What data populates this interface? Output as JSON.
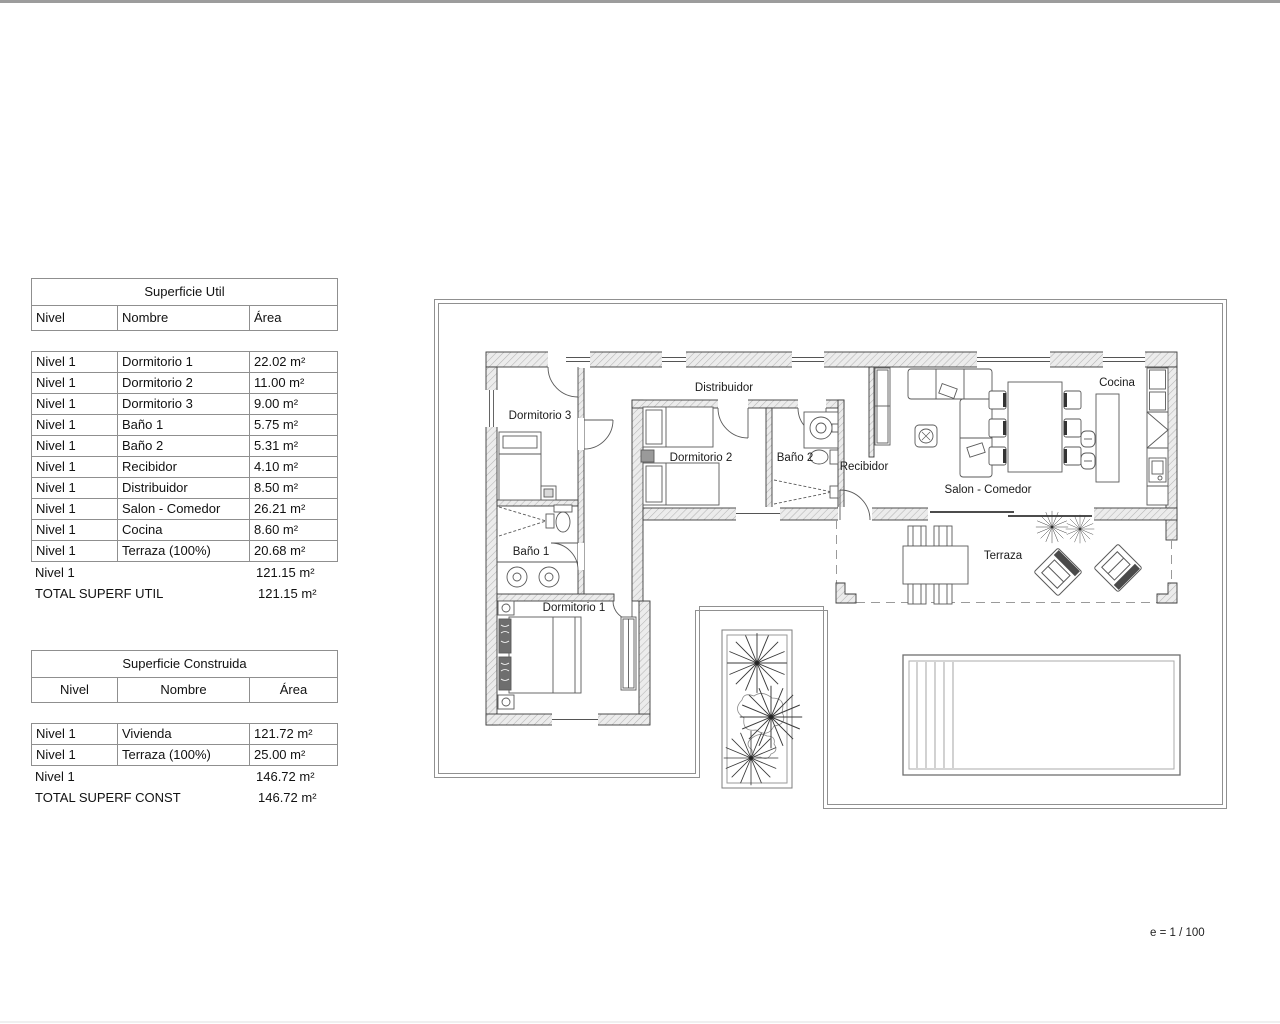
{
  "tables": {
    "util": {
      "title": "Superficie Util",
      "headers": [
        "Nivel",
        "Nombre",
        "Área"
      ],
      "rows": [
        {
          "nivel": "Nivel 1",
          "nombre": "Dormitorio 1",
          "area": "22.02 m²"
        },
        {
          "nivel": "Nivel 1",
          "nombre": "Dormitorio 2",
          "area": "11.00 m²"
        },
        {
          "nivel": "Nivel 1",
          "nombre": "Dormitorio 3",
          "area": "9.00 m²"
        },
        {
          "nivel": "Nivel 1",
          "nombre": "Baño 1",
          "area": "5.75 m²"
        },
        {
          "nivel": "Nivel 1",
          "nombre": "Baño 2",
          "area": "5.31 m²"
        },
        {
          "nivel": "Nivel 1",
          "nombre": "Recibidor",
          "area": "4.10 m²"
        },
        {
          "nivel": "Nivel 1",
          "nombre": "Distribuidor",
          "area": "8.50 m²"
        },
        {
          "nivel": "Nivel 1",
          "nombre": "Salon - Comedor",
          "area": "26.21 m²"
        },
        {
          "nivel": "Nivel 1",
          "nombre": "Cocina",
          "area": "8.60 m²"
        },
        {
          "nivel": "Nivel 1",
          "nombre": "Terraza (100%)",
          "area": "20.68 m²"
        }
      ],
      "subtotal": {
        "label": "Nivel 1",
        "area": "121.15 m²"
      },
      "total": {
        "label": "TOTAL SUPERF UTIL",
        "area": "121.15 m²"
      }
    },
    "construida": {
      "title": "Superficie Construida",
      "headers": [
        "Nivel",
        "Nombre",
        "Área"
      ],
      "rows": [
        {
          "nivel": "Nivel 1",
          "nombre": "Vivienda",
          "area": "121.72 m²"
        },
        {
          "nivel": "Nivel 1",
          "nombre": "Terraza (100%)",
          "area": "25.00 m²"
        }
      ],
      "subtotal": {
        "label": "Nivel 1",
        "area": "146.72 m²"
      },
      "total": {
        "label": "TOTAL SUPERF CONST",
        "area": "146.72 m²"
      }
    }
  },
  "plan": {
    "labels": {
      "distribuidor": "Distribuidor",
      "dormitorio3": "Dormitorio 3",
      "dormitorio2": "Dormitorio 2",
      "bano2": "Baño 2",
      "recibidor": "Recibidor",
      "salon": "Salon - Comedor",
      "cocina": "Cocina",
      "bano1": "Baño 1",
      "dormitorio1": "Dormitorio 1",
      "terraza": "Terraza"
    },
    "scale_note": "e = 1 / 100",
    "colors": {
      "wall_fill": "#ececec",
      "wall_hatch": "#b5b5b5",
      "wall_edge": "#3c3c3c",
      "boundary": "#909090",
      "furniture": "#5a5a5a",
      "dashed": "#9a9a9a"
    }
  }
}
